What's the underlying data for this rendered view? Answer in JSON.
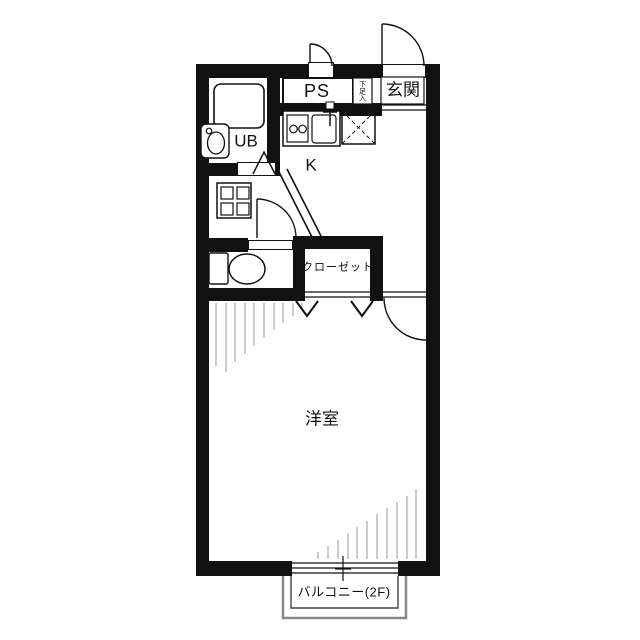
{
  "plan": {
    "type": "apartment-floor-plan",
    "rooms": {
      "entrance": "玄関",
      "shoe_storage": "下足入",
      "pipe_space": "PS",
      "unit_bath": "UB",
      "kitchen": "K",
      "closet": "クローゼット",
      "western_room": "洋室",
      "balcony": "バルコニー(2F)"
    },
    "fixtures": [
      "bathtub",
      "washbasin",
      "toilet",
      "two-burner-stove",
      "kitchen-sink",
      "refrigerator-space-x-box",
      "washing-machine-pan",
      "sliding-window",
      "entrance-door-swing",
      "ps-door-swing",
      "toilet-door-swing",
      "room-door-swing",
      "closet-folding-doors",
      "bath-folding-door"
    ],
    "colors": {
      "wall": "#111111",
      "line": "#111111",
      "hatch": "#999999",
      "balcony_line": "#888888",
      "background": "#ffffff"
    }
  }
}
